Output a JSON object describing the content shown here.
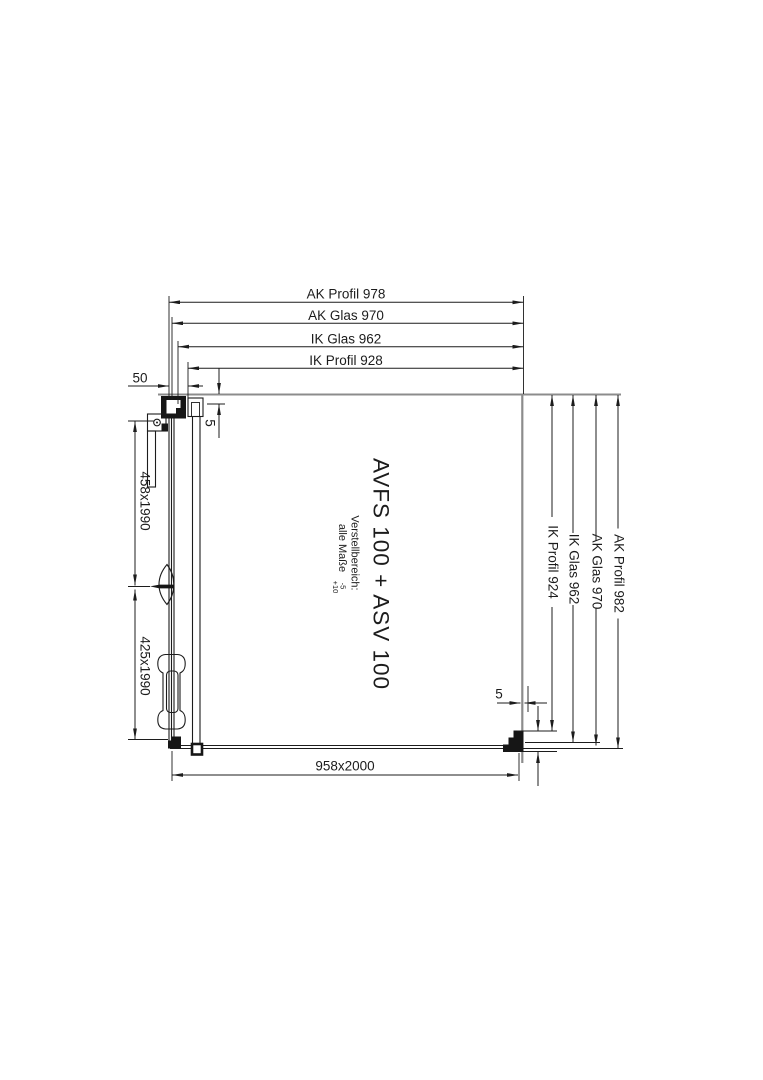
{
  "drawing": {
    "product_label": "AVFS 100 + ASV 100",
    "note": {
      "line1": "Verstellbereich:",
      "line2": "alle Maße",
      "tol_upper": "-5",
      "tol_lower": "+10"
    },
    "dims": {
      "top": [
        "AK Profil 978",
        "AK Glas 970",
        "IK Glas 962",
        "IK Profil 928"
      ],
      "right": [
        "IK Profil 924",
        "IK Glas 962",
        "AK Glas 970",
        "AK Profil 982"
      ],
      "left": [
        "458x1990",
        "425x1990"
      ],
      "bottom_width": "958x2000",
      "wall_profile_width": "50",
      "top_glass_inset": "5",
      "bottom_glass_inset": "5",
      "bottom_bracket_height": "58"
    },
    "colors": {
      "line": "#1c1c1c",
      "reference": "#8c8c8c",
      "background": "#ffffff"
    }
  }
}
